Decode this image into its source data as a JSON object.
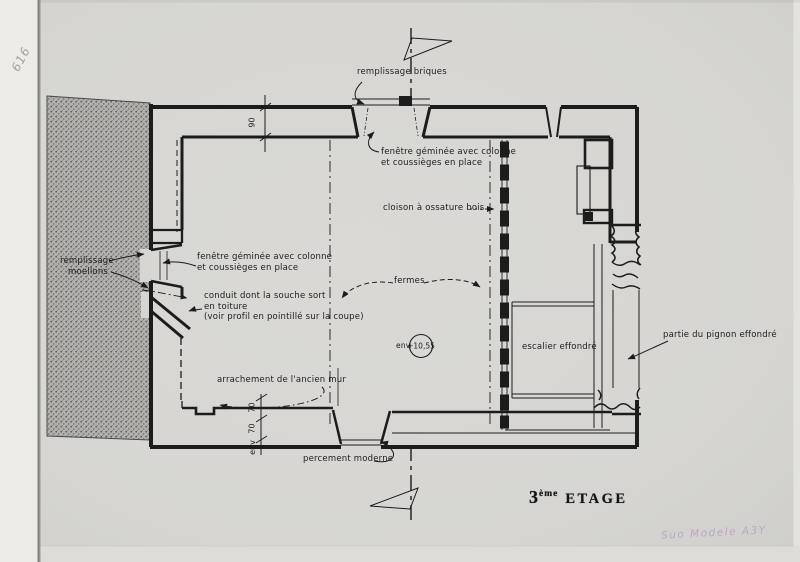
{
  "title": {
    "number": "3",
    "suffix": "ème",
    "word": "ETAGE"
  },
  "annotations": {
    "remplissage_briques": "remplissage briques",
    "fenetre_geminee_top": {
      "line1": "fenêtre géminée avec colonne",
      "line2": "et coussièges en place"
    },
    "cloison": "cloison à ossature bois",
    "remplissage_moellons": {
      "line1": "remplissage",
      "line2": "moellons"
    },
    "fenetre_geminee_left": {
      "line1": "fenêtre géminée avec colonne",
      "line2": "et coussièges en place"
    },
    "conduit": {
      "line1": "conduit dont la souche sort",
      "line2": "en toiture",
      "line3": "(voir profil en pointillé sur la coupe)"
    },
    "fermes": "fermes",
    "level_marker": {
      "prefix": "env",
      "value": "+10,55"
    },
    "escalier": "escalier effondré",
    "pignon": "partie du pignon effondré",
    "arrachement": "arrachement de l'ancien mur",
    "percement": "percement moderne"
  },
  "dimensions": {
    "top_wall": "90",
    "bottom_wall": {
      "upper": "70",
      "lower": "70",
      "prefix": "env"
    }
  },
  "handwritten": {
    "corner_code": "616",
    "archive_note": "Suo Modele A3Y"
  },
  "colors": {
    "paper": "#d6d5d1",
    "ink": "#1c1c1c",
    "hatch": "#8f8e8b",
    "pencil": "#a3a29e",
    "pen_note": "#b49bc8"
  }
}
